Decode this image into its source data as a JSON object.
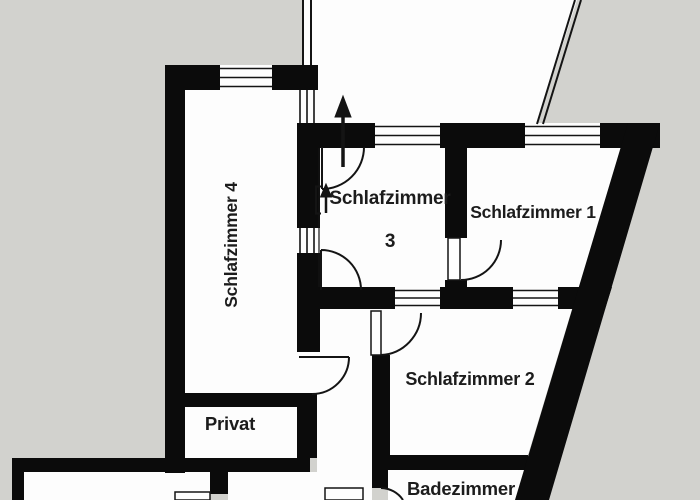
{
  "colors": {
    "background": "#d2d2ce",
    "wall": "#0b0b0b",
    "room_fill": "#fdfdfd",
    "line": "#141414",
    "text": "#1c1c1c"
  },
  "rooms": [
    {
      "id": "schlafzimmer-3",
      "label": "Schlafzimmer",
      "label2": "3"
    },
    {
      "id": "schlafzimmer-1",
      "label": "Schlafzimmer 1"
    },
    {
      "id": "schlafzimmer-2",
      "label": "Schlafzimmer 2"
    },
    {
      "id": "schlafzimmer-4",
      "label": "Schlafzimmer 4"
    },
    {
      "id": "privat",
      "label": "Privat"
    },
    {
      "id": "badezimmer",
      "label": "Badezimmer"
    }
  ]
}
